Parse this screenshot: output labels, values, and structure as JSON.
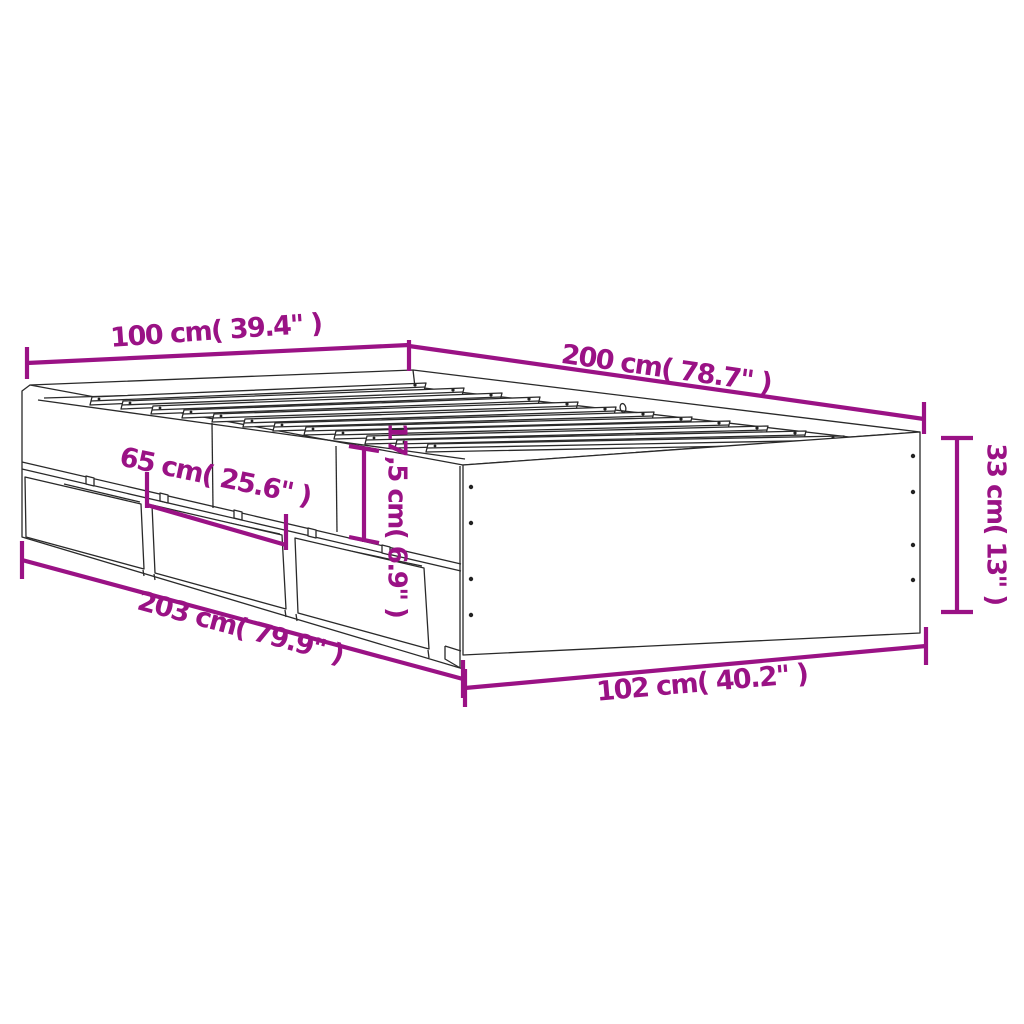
{
  "diagram": {
    "subject": "bed-frame-with-underbed-drawers",
    "style": "perspective-line-art",
    "background": "#ffffff",
    "line_color": "#2a2a2a",
    "accent_color": "#9A1285",
    "slat_count": 12,
    "drawer_count": 3,
    "screw_count": 8
  },
  "labels": {
    "head_width": "100 cm( 39.4\" )",
    "side_length": "200 cm( 78.7\" )",
    "frame_height": "33 cm( 13\" )",
    "drawer_width": "65 cm( 25.6\" )",
    "rail_height": "17,5 cm( 6.9\" )",
    "overall_length": "203 cm( 79.9\" )",
    "overall_width": "102 cm( 40.2\" )"
  }
}
